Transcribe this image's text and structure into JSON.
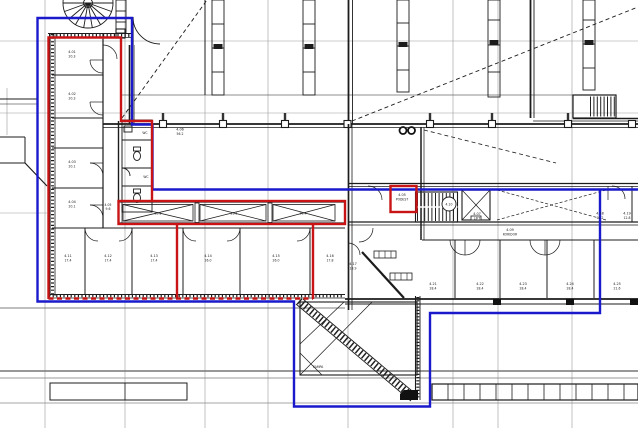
{
  "drawing": {
    "kind": "architectural floor plan (CAD screenshot, level 4)",
    "colors": {
      "zone_blue": "#1a1acc",
      "zone_red": "#c81414",
      "linework": "#1c1c1c",
      "grid": "#9a9a9a",
      "background": "#ffffff"
    }
  },
  "labels": {
    "left_rooms": [
      {
        "a": "4.01",
        "b": "20.3"
      },
      {
        "a": "4.02",
        "b": "20.3"
      },
      {
        "a": "4.03",
        "b": "20.1"
      },
      {
        "a": "4.04",
        "b": "20.1"
      }
    ],
    "hall_small": {
      "a": "4.05",
      "b": "9.6"
    },
    "toilets": {
      "wc1": "WC",
      "wc2": "WC"
    },
    "mid_room": {
      "a": "4.06",
      "b": "56.2"
    },
    "corridor_boxes": [
      "25.1",
      "25.1",
      "20.4"
    ],
    "bottom_rooms": [
      {
        "a": "4.11",
        "b": "17.4"
      },
      {
        "a": "4.12",
        "b": "17.4"
      },
      {
        "a": "4.13",
        "b": "17.4"
      },
      {
        "a": "4.14",
        "b": "26.0"
      },
      {
        "a": "4.15",
        "b": "26.0"
      },
      {
        "a": "4.16",
        "b": "17.8"
      }
    ],
    "diag_room": {
      "a": "4.17",
      "b": "18.9"
    },
    "ramp": "RAMPA",
    "right_corridor": {
      "podest": {
        "a": "4.05",
        "b": "PODEST"
      },
      "circle": "4.10",
      "lift": {
        "a": "4.07",
        "b": "LIFT"
      },
      "koridor": {
        "a": "4.09",
        "b": "KORIDOR"
      },
      "k2": {
        "a": "4.18",
        "b": "15.2"
      },
      "k3": {
        "a": "4.19",
        "b": "12.8"
      }
    },
    "right_rooms": [
      {
        "a": "4.21",
        "b": "28.4"
      },
      {
        "a": "4.22",
        "b": "28.4"
      },
      {
        "a": "4.23",
        "b": "28.4"
      },
      {
        "a": "4.24",
        "b": "28.4"
      },
      {
        "a": "4.25",
        "b": "21.6"
      }
    ]
  }
}
